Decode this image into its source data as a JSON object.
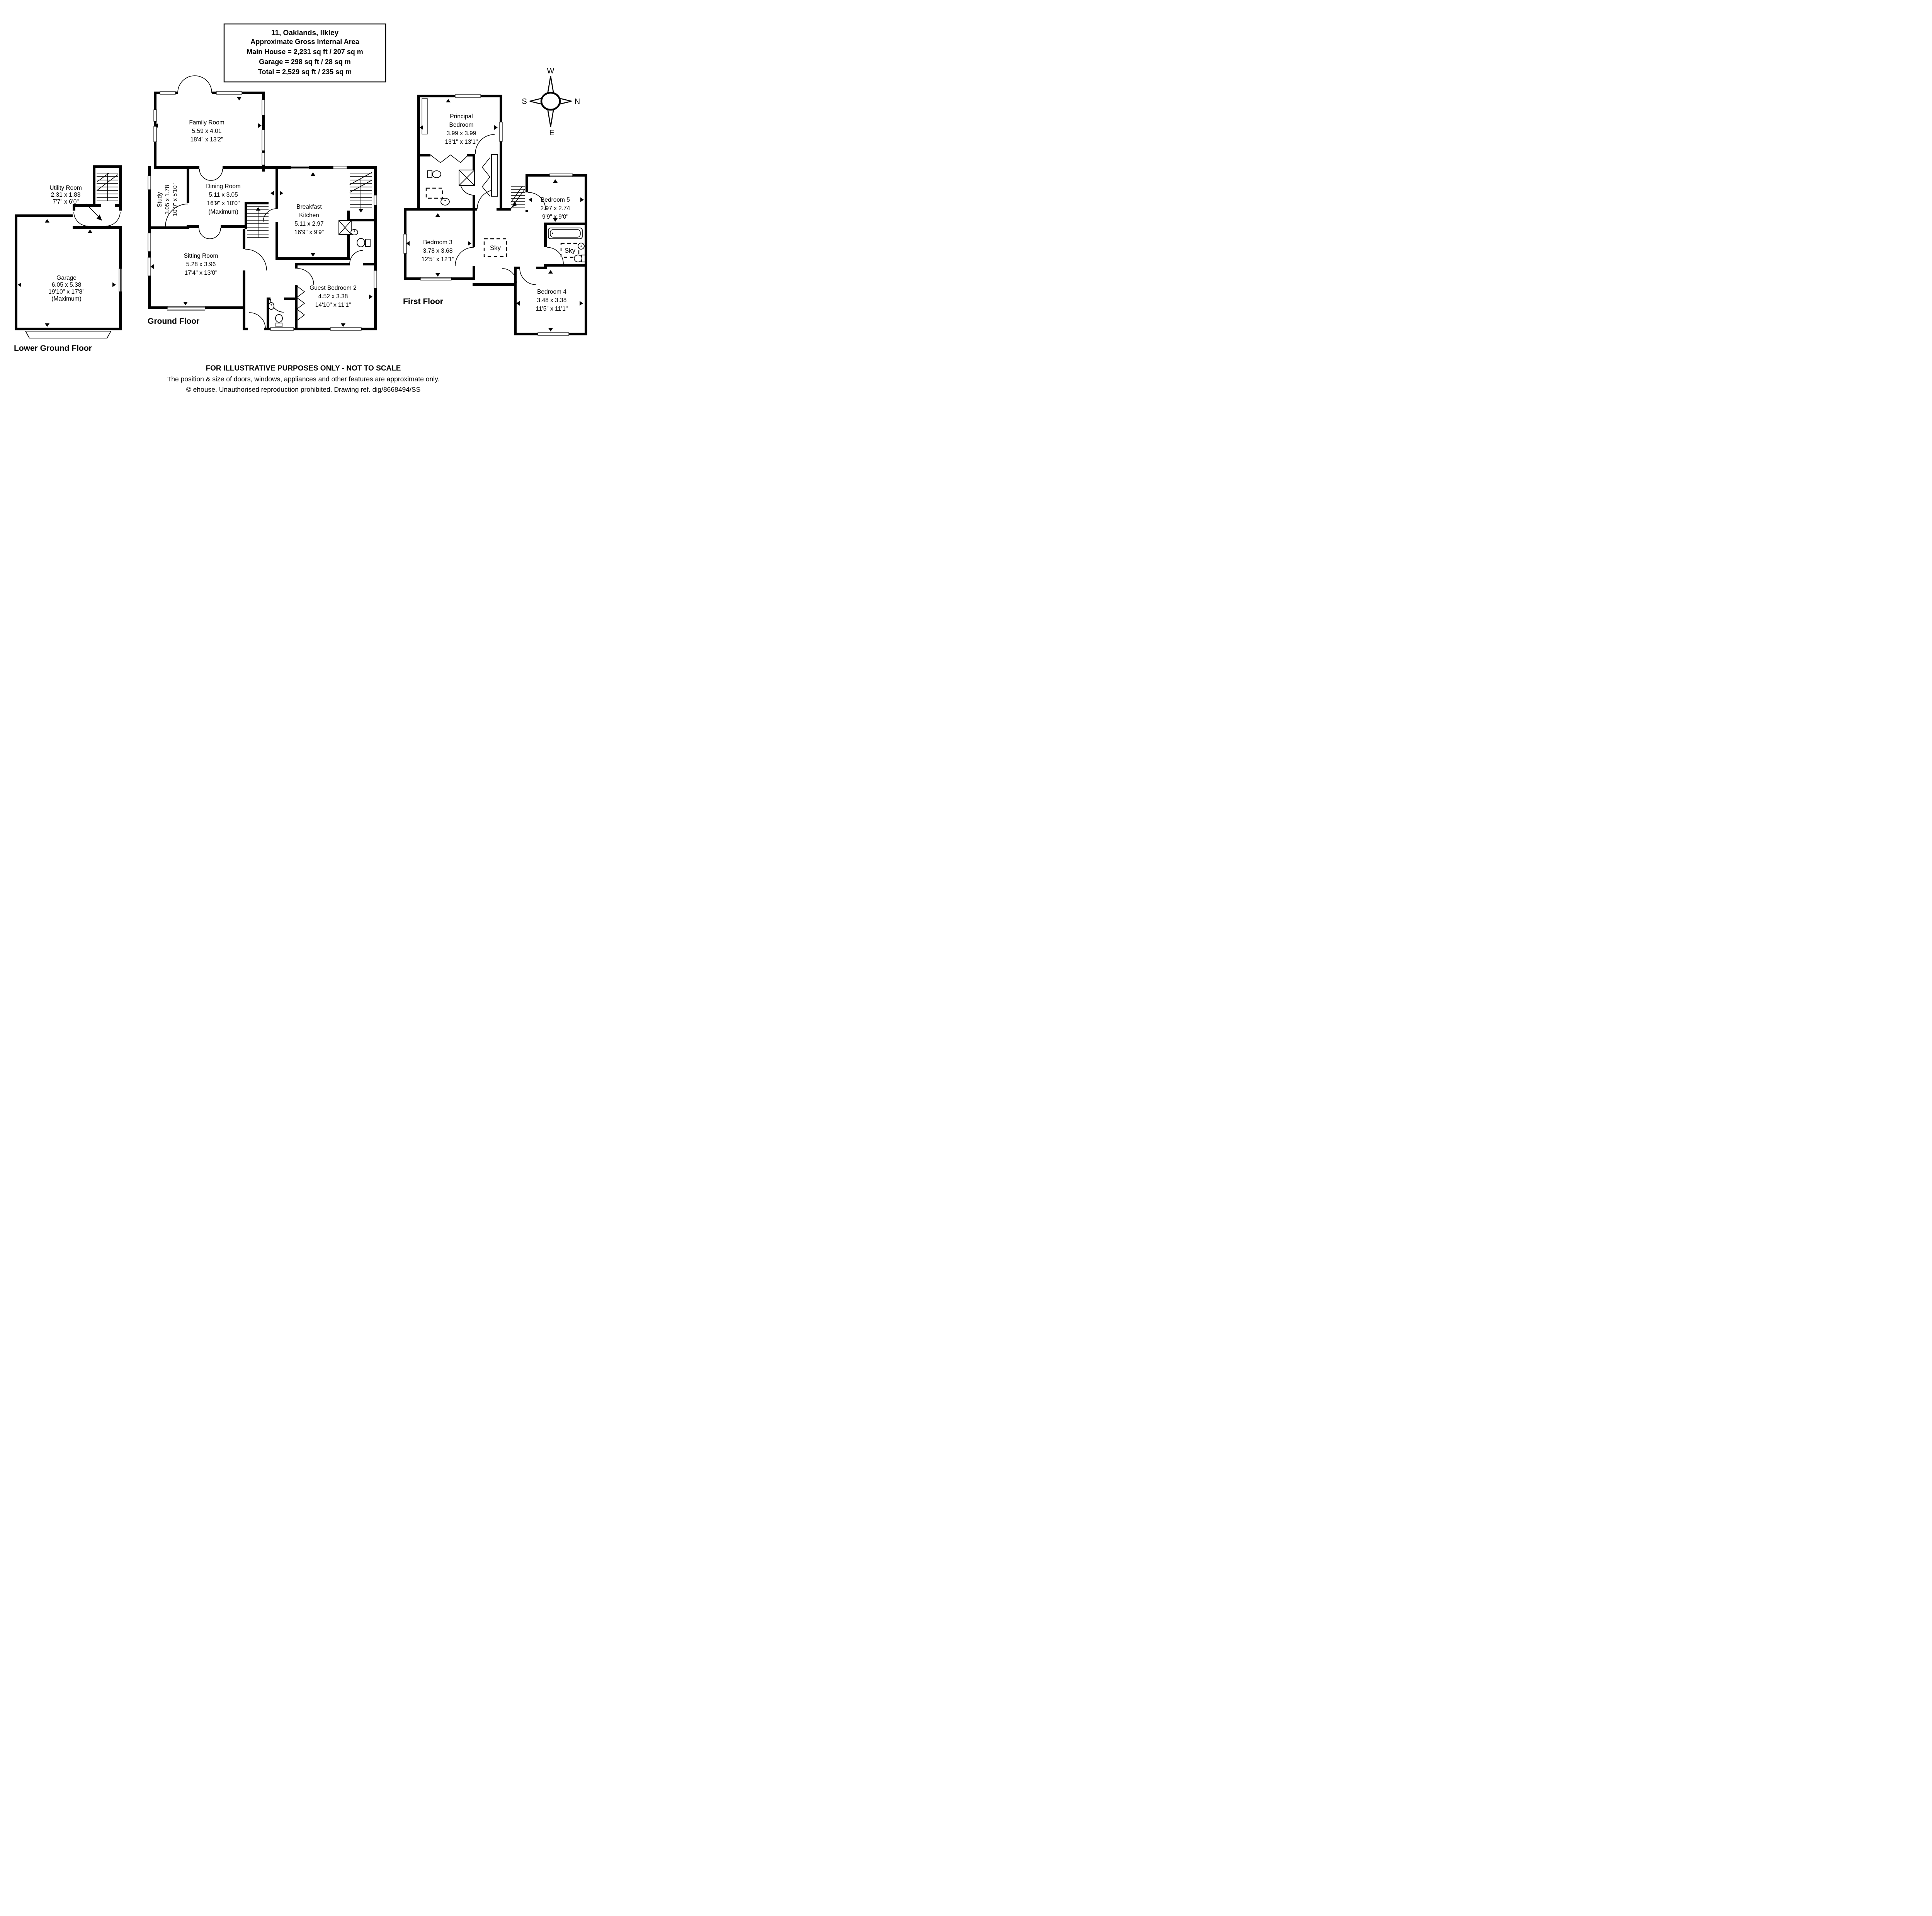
{
  "title_box": {
    "lines": [
      "11, Oaklands, Ilkley",
      "Approximate Gross Internal Area",
      "Main House = 2,231 sq ft / 207 sq m",
      "Garage = 298 sq ft / 28 sq m",
      "Total = 2,529 sq ft / 235 sq m"
    ]
  },
  "compass": {
    "north": "N",
    "east": "E",
    "south": "S",
    "west": "W"
  },
  "floors": {
    "lower_ground": {
      "label": "Lower Ground Floor",
      "rooms": [
        {
          "name": "Utility Room",
          "m": "2.31 x 1.83",
          "ft": "7'7\" x 6'0\""
        },
        {
          "name": "Garage",
          "m": "6.05 x 5.38",
          "ft": "19'10\" x 17'8\"",
          "note": "(Maximum)"
        }
      ]
    },
    "ground": {
      "label": "Ground Floor",
      "rooms": [
        {
          "name": "Family Room",
          "m": "5.59 x 4.01",
          "ft": "18'4\" x 13'2\""
        },
        {
          "name": "Study",
          "m": "3.05 x 1.78",
          "ft": "10'0\" x 5'10\""
        },
        {
          "name": "Dining Room",
          "m": "5.11 x 3.05",
          "ft": "16'9\" x 10'0\"",
          "note": "(Maximum)"
        },
        {
          "name": "Breakfast",
          "name2": "Kitchen",
          "m": "5.11 x 2.97",
          "ft": "16'9\" x 9'9\""
        },
        {
          "name": "Sitting Room",
          "m": "5.28 x 3.96",
          "ft": "17'4\" x 13'0\""
        },
        {
          "name": "Guest Bedroom 2",
          "m": "4.52 x 3.38",
          "ft": "14'10\" x 11'1\""
        }
      ]
    },
    "first": {
      "label": "First Floor",
      "rooms": [
        {
          "name": "Principal",
          "name2": "Bedroom",
          "m": "3.99 x 3.99",
          "ft": "13'1\" x 13'1\""
        },
        {
          "name": "Bedroom 3",
          "m": "3.78 x 3.68",
          "ft": "12'5\" x 12'1\""
        },
        {
          "name": "Bedroom 5",
          "m": "2.97 x 2.74",
          "ft": "9'9\" x 9'0\""
        },
        {
          "name": "Bedroom 4",
          "m": "3.48 x 3.38",
          "ft": "11'5\" x 11'1\""
        }
      ],
      "skylights": [
        "Sky",
        "Sky"
      ]
    }
  },
  "footer": {
    "line1": "FOR ILLUSTRATIVE PURPOSES ONLY - NOT TO SCALE",
    "line2": "The position & size of doors, windows, appliances and other features are approximate only.",
    "line3": "© ehouse. Unauthorised reproduction prohibited. Drawing ref. dig/8668494/SS"
  }
}
